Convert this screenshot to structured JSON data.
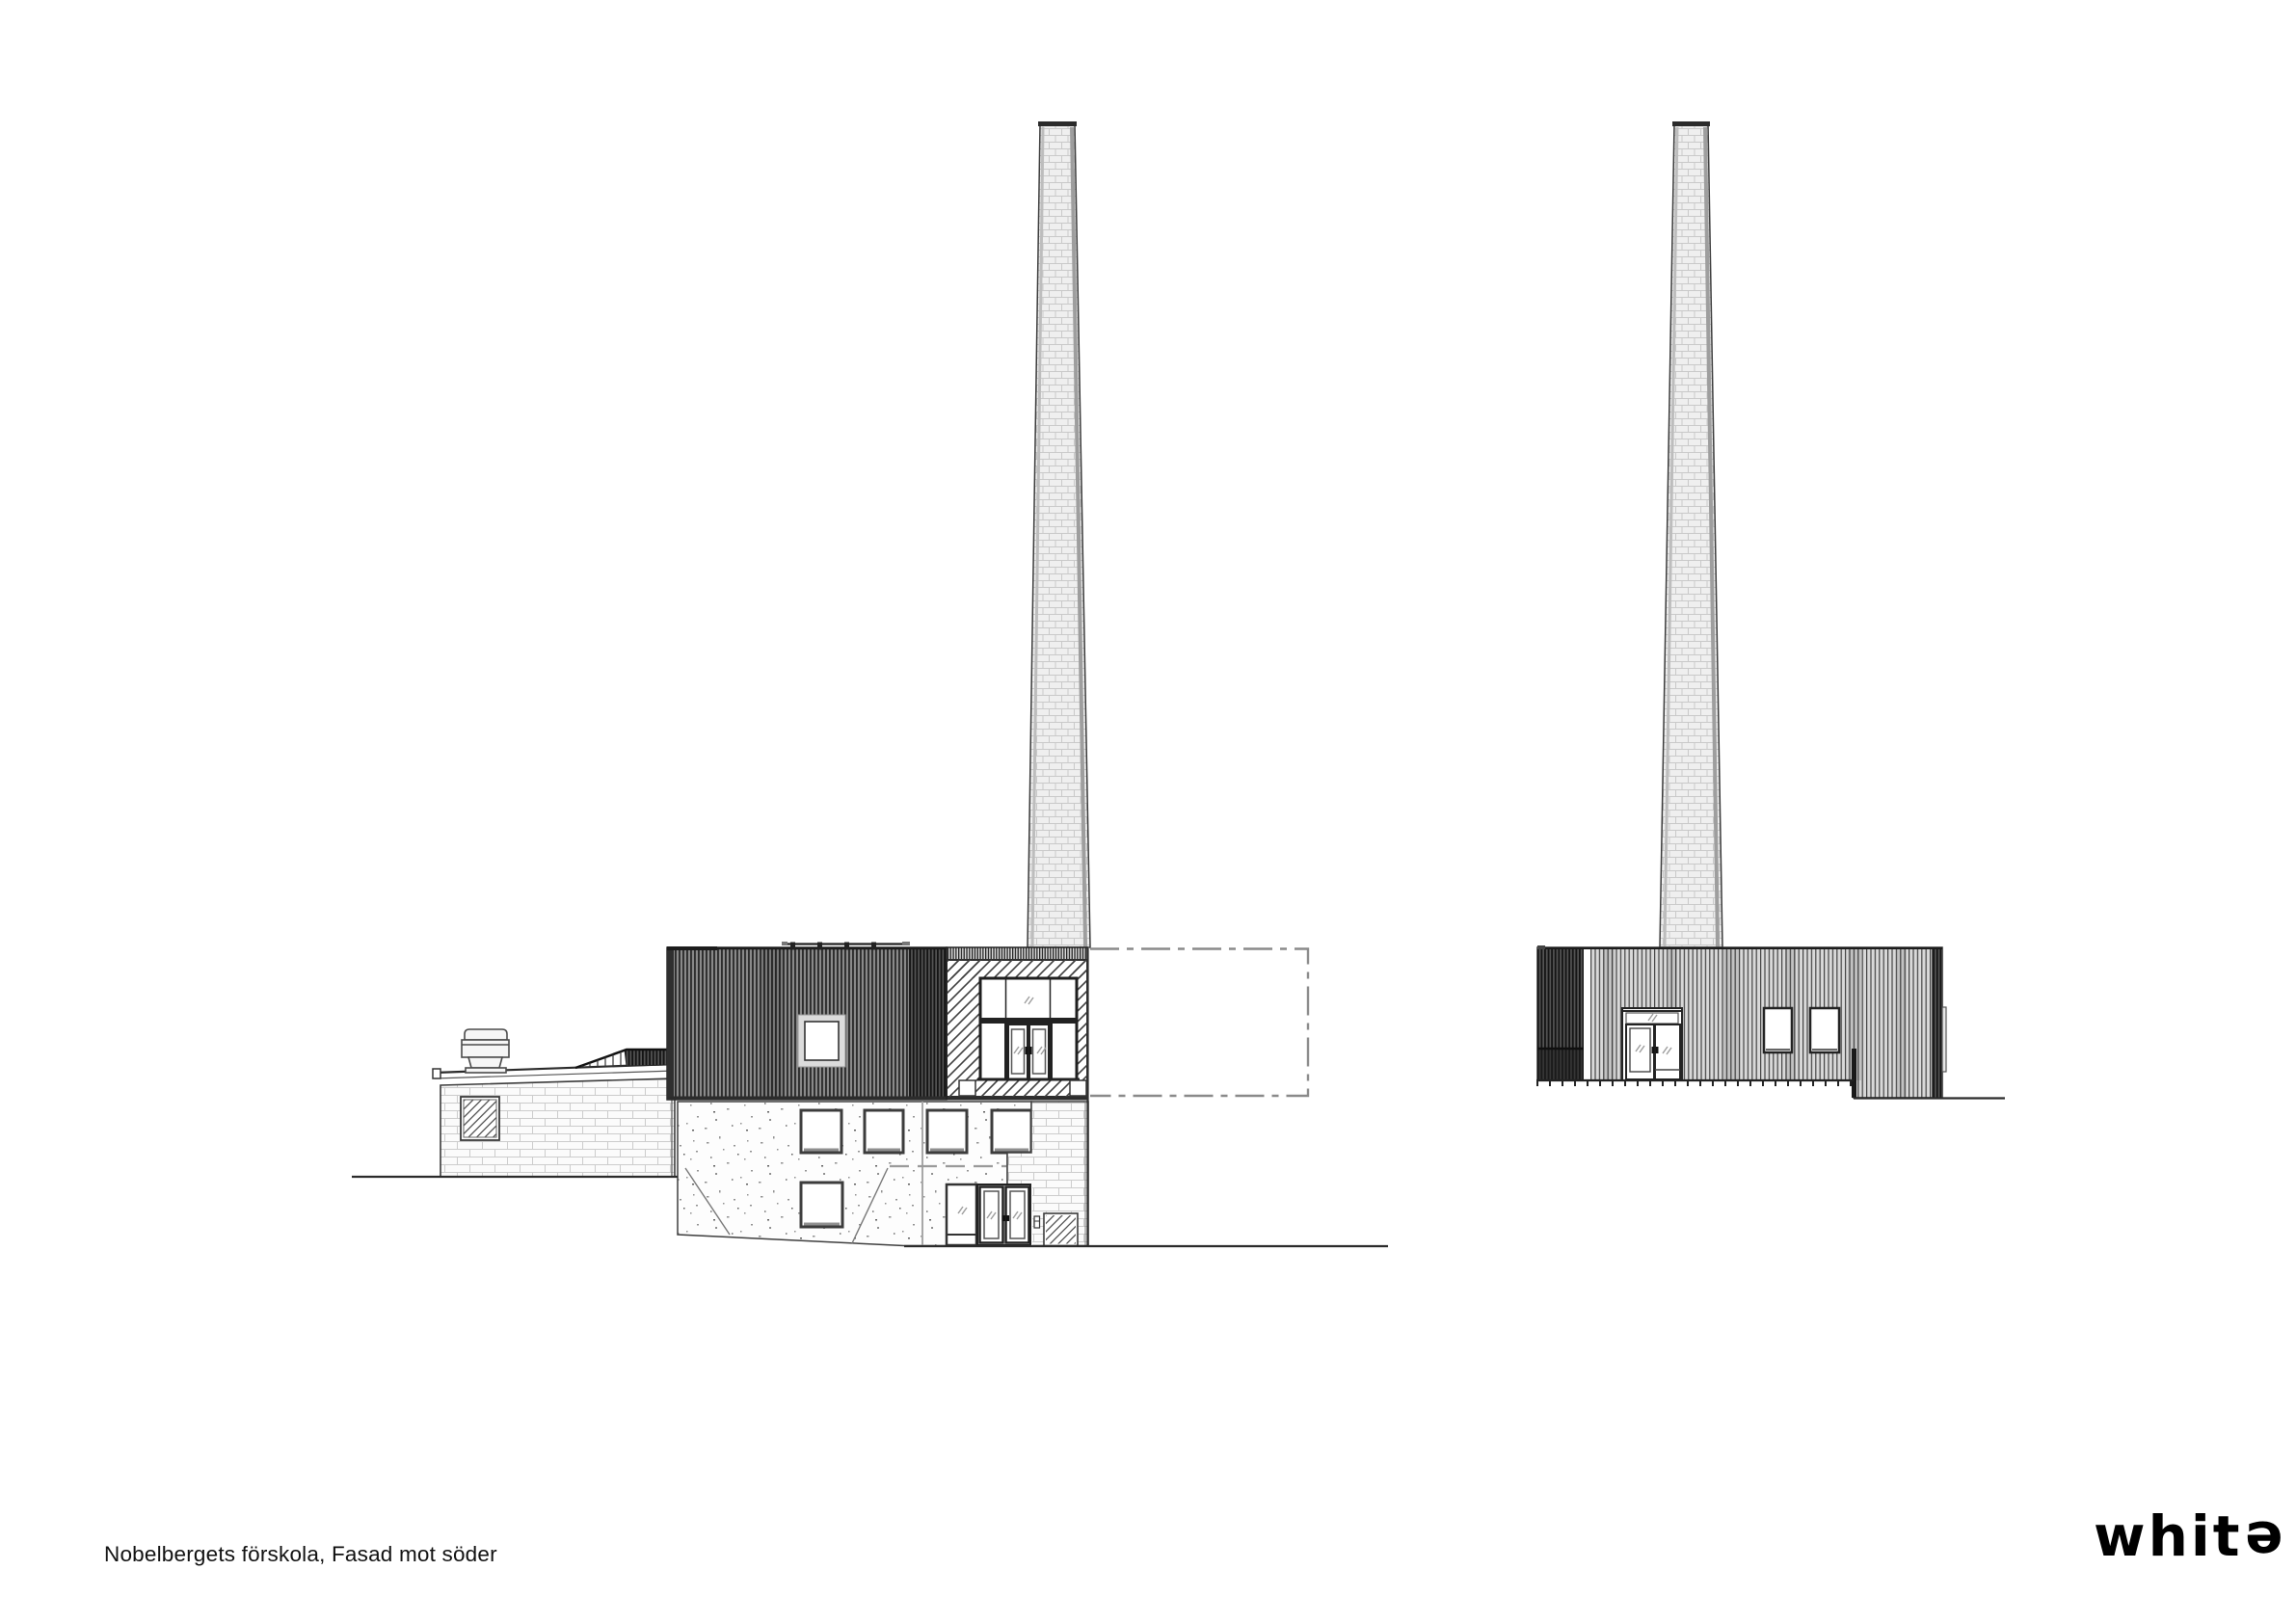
{
  "sheet": {
    "background": "#ffffff",
    "caption": "Nobelbergets förskola, Fasad mot söder"
  },
  "logo": {
    "word_start": "whit",
    "word_flipped_letter": "e"
  },
  "colors": {
    "ink": "#2e2e2e",
    "dash_dot": "#8a8a8a",
    "dark_cladding": "#2c2c2c",
    "light_cladding": "#d9d9d9",
    "brick_joint": "#cccccc",
    "concrete_speckle": "#909090"
  }
}
